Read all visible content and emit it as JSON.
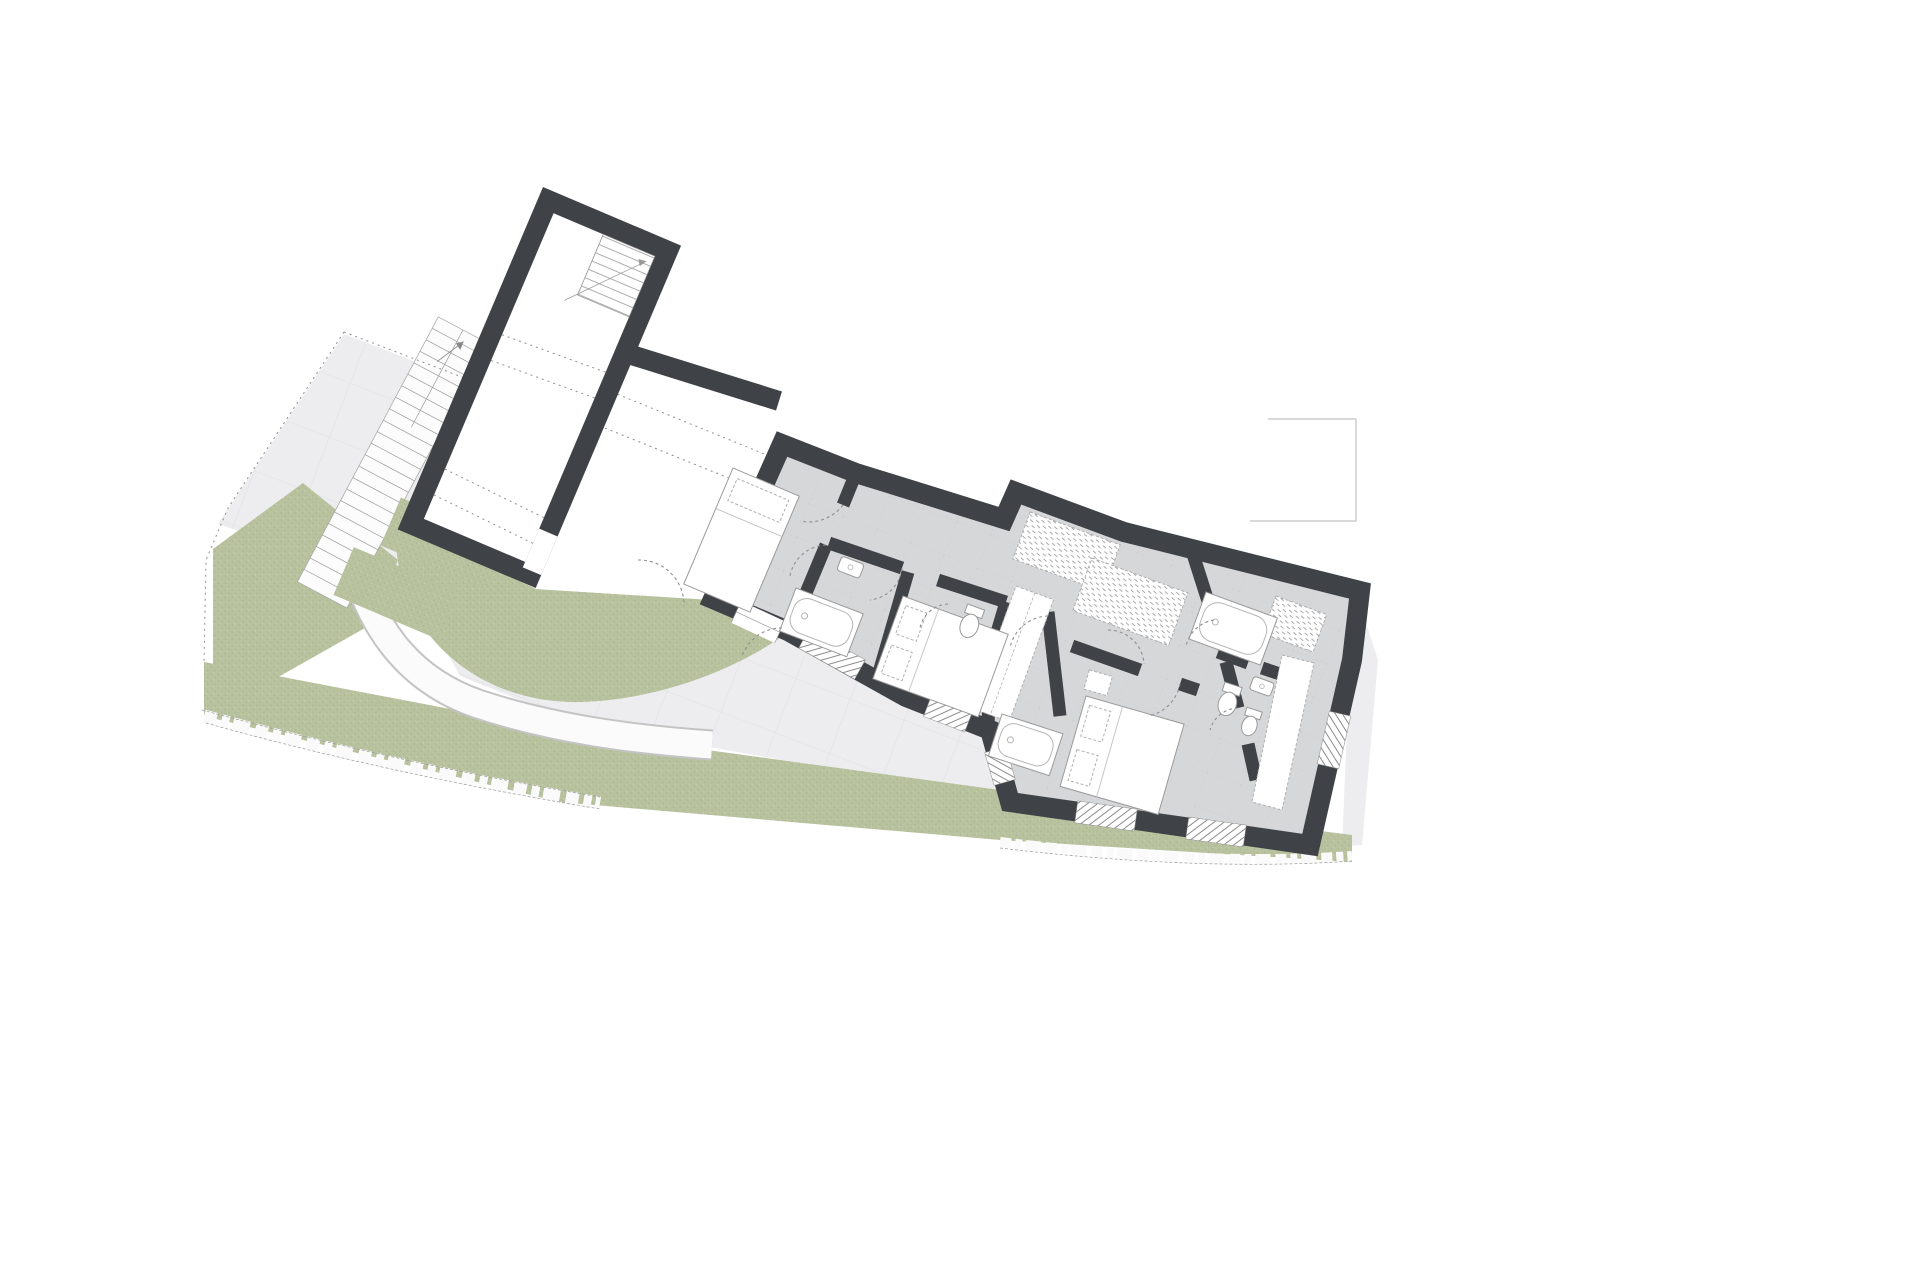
{
  "canvas": {
    "width": 1920,
    "height": 1280
  },
  "drawing": {
    "kind": "architectural-floor-plan",
    "text_labels": []
  },
  "colors": {
    "wall": "#3f4347",
    "floor": "#d6d7d9",
    "floorLine": "#c2c3c7",
    "terrace": "#ededef",
    "terraceLine": "#e0e1e4",
    "grass": "#b8c29e",
    "grassDark": "#9fae83",
    "paper": "#ffffff",
    "thin": "#9a9a9a",
    "furn": "#b0b0b0",
    "dash": "#8f8f8f"
  },
  "elements": {
    "site": [
      "lawn-band",
      "lawn-wedge",
      "lawn-curved",
      "planting-beds",
      "exterior-stairs",
      "garden-path",
      "paved-terrace",
      "stone-edge",
      "site-boundary",
      "neighbor-outline"
    ],
    "buildings": [
      "garage",
      "entry-breezeway",
      "bedroom-1",
      "corridor",
      "bathroom-1",
      "wc-1",
      "bedroom-2",
      "bathroom-2",
      "hall",
      "bedroom-3",
      "bathroom-3",
      "wc-2"
    ],
    "furniture": [
      "single-bed",
      "double-bed-2",
      "double-bed-3",
      "wardrobe-column",
      "wardrobe-hatch-a",
      "wardrobe-hatch-b",
      "wardrobe-hatch-c",
      "wardrobe-3"
    ],
    "fixtures": [
      "shower-1",
      "bathtub-2",
      "bathtub-3",
      "toilet-1",
      "toilet-2",
      "bidet",
      "sink-1",
      "sink-2"
    ],
    "openings": {
      "windows": 7,
      "door_swings": 10
    },
    "counts": {
      "planting_beds": 3,
      "stair_steps": 22,
      "beds": 3
    }
  }
}
